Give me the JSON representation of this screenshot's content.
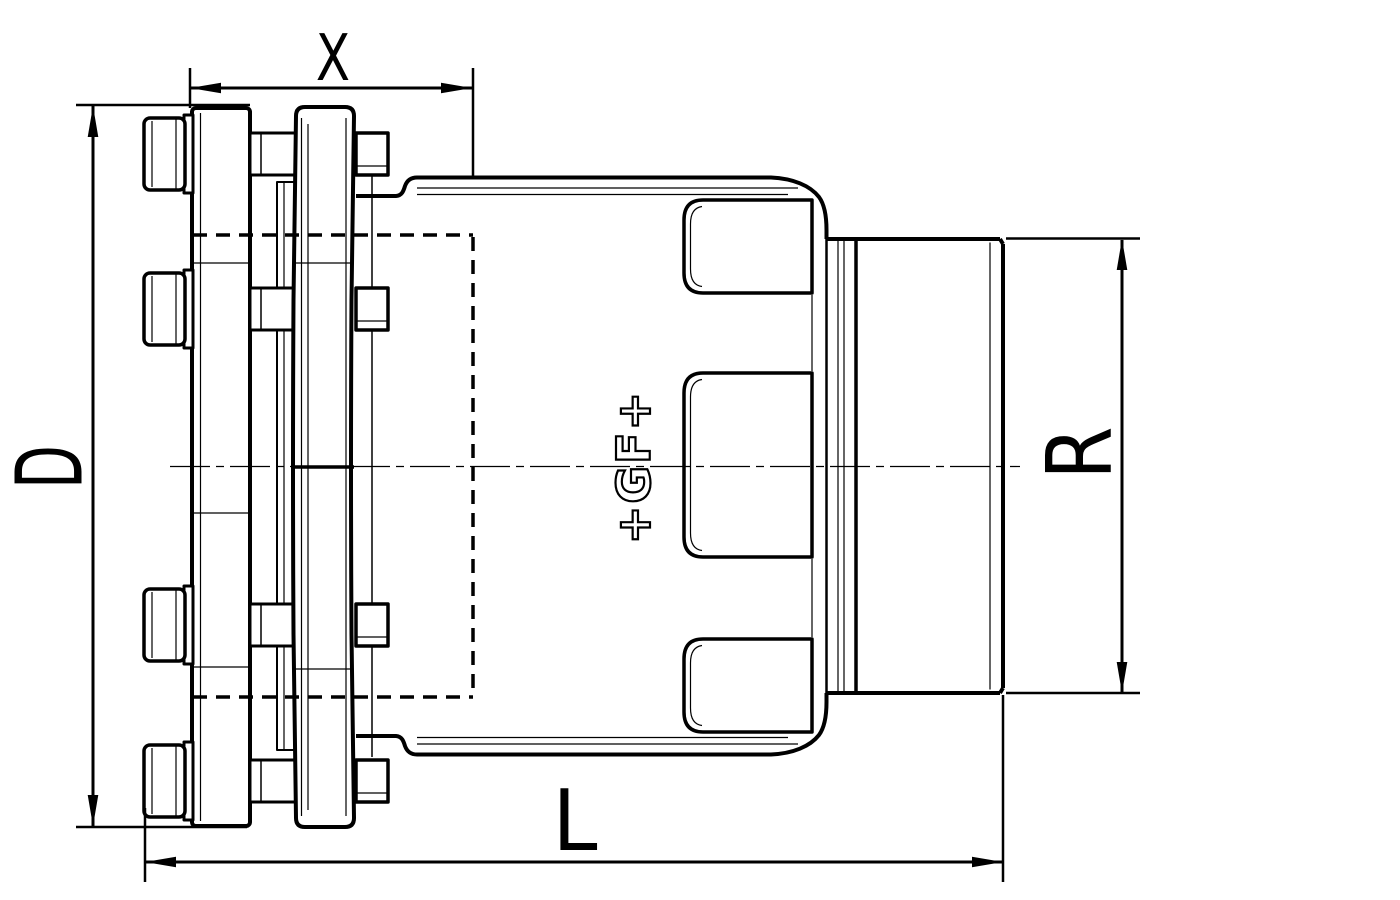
{
  "drawing": {
    "dimensions": {
      "x": {
        "label": "X"
      },
      "d": {
        "label": "D"
      },
      "r": {
        "label": "R"
      },
      "l": {
        "label": "L"
      }
    },
    "logo": {
      "text": "+GF+"
    },
    "colors": {
      "line": "#000000",
      "background": "#ffffff"
    }
  }
}
